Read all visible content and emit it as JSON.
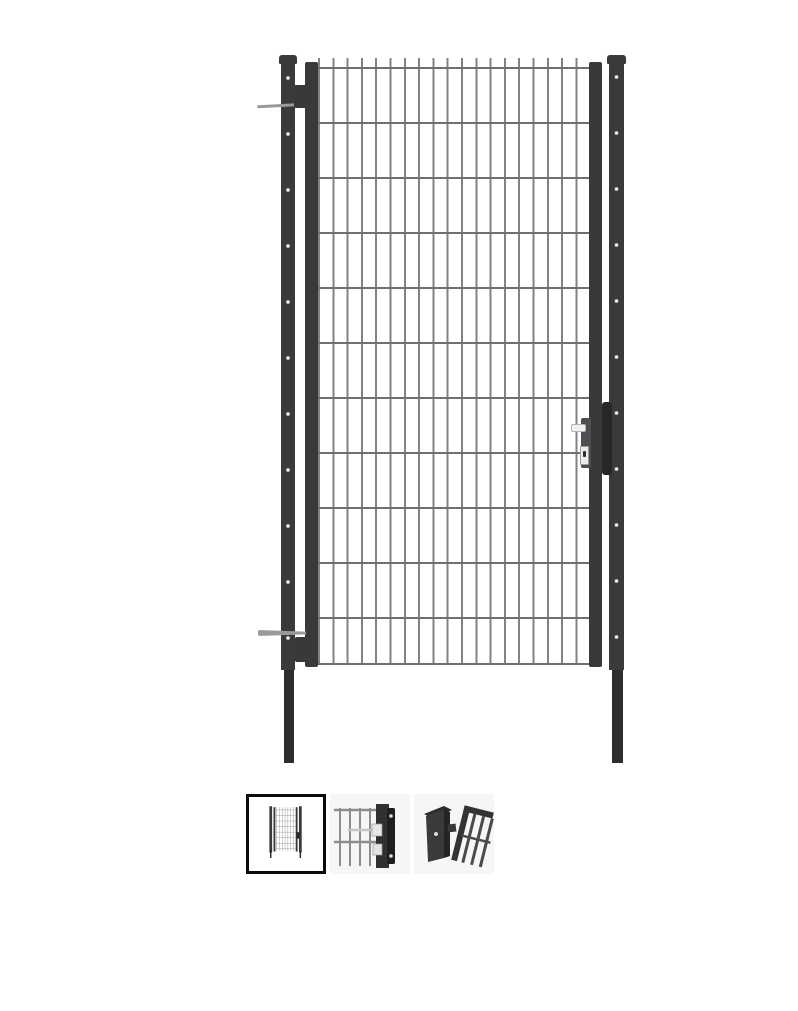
{
  "page": {
    "background": "#ffffff"
  },
  "product_viewer": {
    "main_image": {
      "description": "anthracite double-wire mesh single garden gate mounted between two riveted posts with lock and handle",
      "parts": {
        "left_post": "riveted-post-with-ground-spike",
        "right_post": "riveted-post-with-ground-spike",
        "gate_leaf": "wire-mesh-gate-leaf",
        "top_hinge": "hinge-with-bolt",
        "bottom_hinge": "hinge-with-bracket",
        "lock": "lock-case-with-lever-handle-and-cylinder"
      },
      "colors": {
        "post": "#3a3a3c",
        "post_spike": "#2e2e30",
        "frame": "#39393b",
        "wire_vertical": "#828282",
        "wire_horizontal": "#6f6f6f",
        "rivet": "#e9e9e9",
        "lock_plate": "#27272a",
        "lock_case": "#4e4e52",
        "handle": "#f1f1f1",
        "hardware": "#9a9a9a"
      }
    },
    "thumbnails": {
      "background": "#f6f6f6",
      "selected_border": "#0a0a0a",
      "items": [
        {
          "label": "gate-front-view-thumbnail",
          "selected": true
        },
        {
          "label": "lock-detail-thumbnail",
          "selected": false
        },
        {
          "label": "post-gate-corner-thumbnail",
          "selected": false
        }
      ]
    }
  }
}
